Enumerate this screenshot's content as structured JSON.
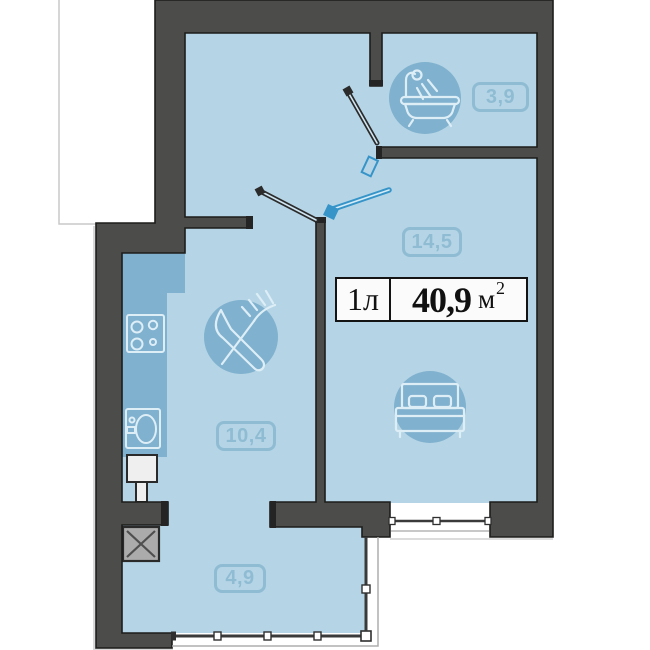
{
  "title": {
    "type": "1л",
    "area": "40,9",
    "unit": "м",
    "sup": "2"
  },
  "rooms": {
    "bathroom": {
      "area": "3,9",
      "icon": "bathtub-icon"
    },
    "living": {
      "area": "14,5",
      "icon": "bed-icon"
    },
    "kitchen": {
      "area": "10,4",
      "icon": "fork-knife-icon"
    },
    "hall": {
      "area": "4,9"
    }
  },
  "icons": {
    "bathroom": "bathtub-icon",
    "living": "bed-icon",
    "kitchen": "fork-knife-icon",
    "kitchen_fixtures": [
      "stove-icon",
      "sink-icon",
      "boiler"
    ],
    "shaft": "crossed-box-vent-icon"
  },
  "colors": {
    "wall": "#4c4c4a",
    "wall_outline": "#1d1d1b",
    "room": "#b5d5e6",
    "fixture": "#80b1ce",
    "icon_stroke": "#ddeef7",
    "label": "#8fbcd3",
    "entrance_door": "#3694c8",
    "interior_door": "#2b2b2b",
    "vent_fill": "#ababab",
    "window": "#3a3a3a",
    "title_bg": "#fbfbfb",
    "title_text": "#111111"
  }
}
